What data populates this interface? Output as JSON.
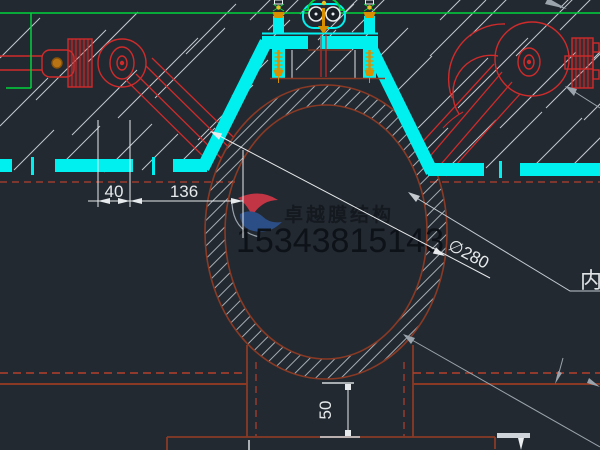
{
  "watermark": {
    "brand": "卓越膜结构",
    "phone": "15343815143"
  },
  "dimensions": {
    "width_40": "40",
    "width_136": "136",
    "diameter": "∅280",
    "height_50": "50"
  },
  "labels": {
    "right_edge_label": "内"
  },
  "colors": {
    "background": "#232931",
    "membrane_cyan": "#00f0f0",
    "grid_green": "#00d23c",
    "clamp_red": "#cf2b2b",
    "pipe_rust": "#8a3a24",
    "dashed_red": "#b5402c",
    "bolt_orange": "#d89000",
    "dimension_white": "#e6eaec",
    "watermark_dark": "#14181f",
    "logo_red": "#c23545",
    "logo_blue": "#2c4e86"
  }
}
